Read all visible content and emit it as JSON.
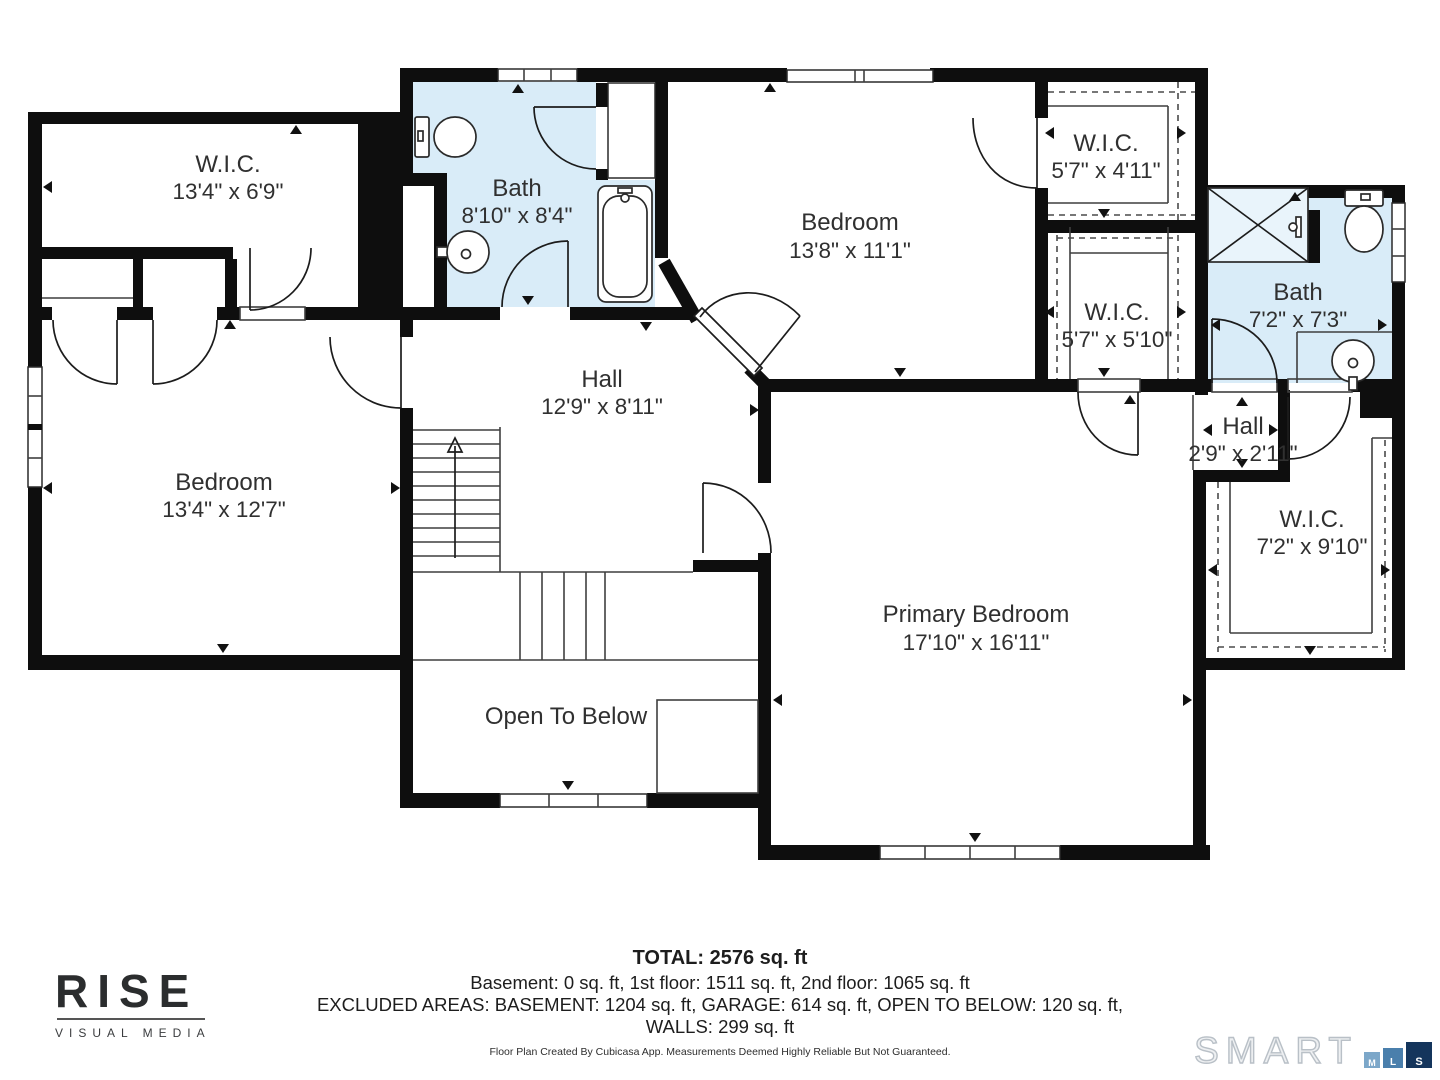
{
  "rooms": {
    "wic_tl": {
      "name": "W.I.C.",
      "dims": "13'4\" x 6'9\""
    },
    "bath_tl": {
      "name": "Bath",
      "dims": "8'10\" x 8'4\""
    },
    "bedroom_tr": {
      "name": "Bedroom",
      "dims": "13'8\" x 11'1\""
    },
    "wic_1": {
      "name": "W.I.C.",
      "dims": "5'7\" x 4'11\""
    },
    "wic_2": {
      "name": "W.I.C.",
      "dims": "5'7\" x 5'10\""
    },
    "bath_r": {
      "name": "Bath",
      "dims": "7'2\" x 7'3\""
    },
    "hall_c": {
      "name": "Hall",
      "dims": "12'9\" x 8'11\""
    },
    "bedroom_l": {
      "name": "Bedroom",
      "dims": "13'4\" x 12'7\""
    },
    "hall_r": {
      "name": "Hall",
      "dims": "2'9\" x 2'11\""
    },
    "wic_r": {
      "name": "W.I.C.",
      "dims": "7'2\" x 9'10\""
    },
    "primary": {
      "name": "Primary Bedroom",
      "dims": "17'10\" x 16'11\""
    },
    "open_below": {
      "name": "Open To Below",
      "dims": ""
    }
  },
  "summary": {
    "total": "TOTAL: 2576 sq. ft",
    "floors": "Basement: 0 sq. ft, 1st floor: 1511 sq. ft, 2nd floor: 1065 sq. ft",
    "excluded": "EXCLUDED AREAS: BASEMENT: 1204 sq. ft, GARAGE: 614 sq. ft, OPEN TO BELOW: 120 sq. ft,",
    "walls": "WALLS: 299 sq. ft",
    "disclaimer": "Floor Plan Created By Cubicasa App. Measurements Deemed Highly Reliable But Not Guaranteed."
  },
  "branding": {
    "rise_name": "RISE",
    "rise_tagline": "VISUAL MEDIA",
    "smart_name": "SMART",
    "mls_m": "M",
    "mls_l": "L",
    "mls_s": "S"
  },
  "colors": {
    "bath_fill": "#d9ecf8",
    "wall": "#0e0e0e",
    "mls_m": "#7ca7c9",
    "mls_l": "#4a7fac",
    "mls_s": "#14355c"
  }
}
